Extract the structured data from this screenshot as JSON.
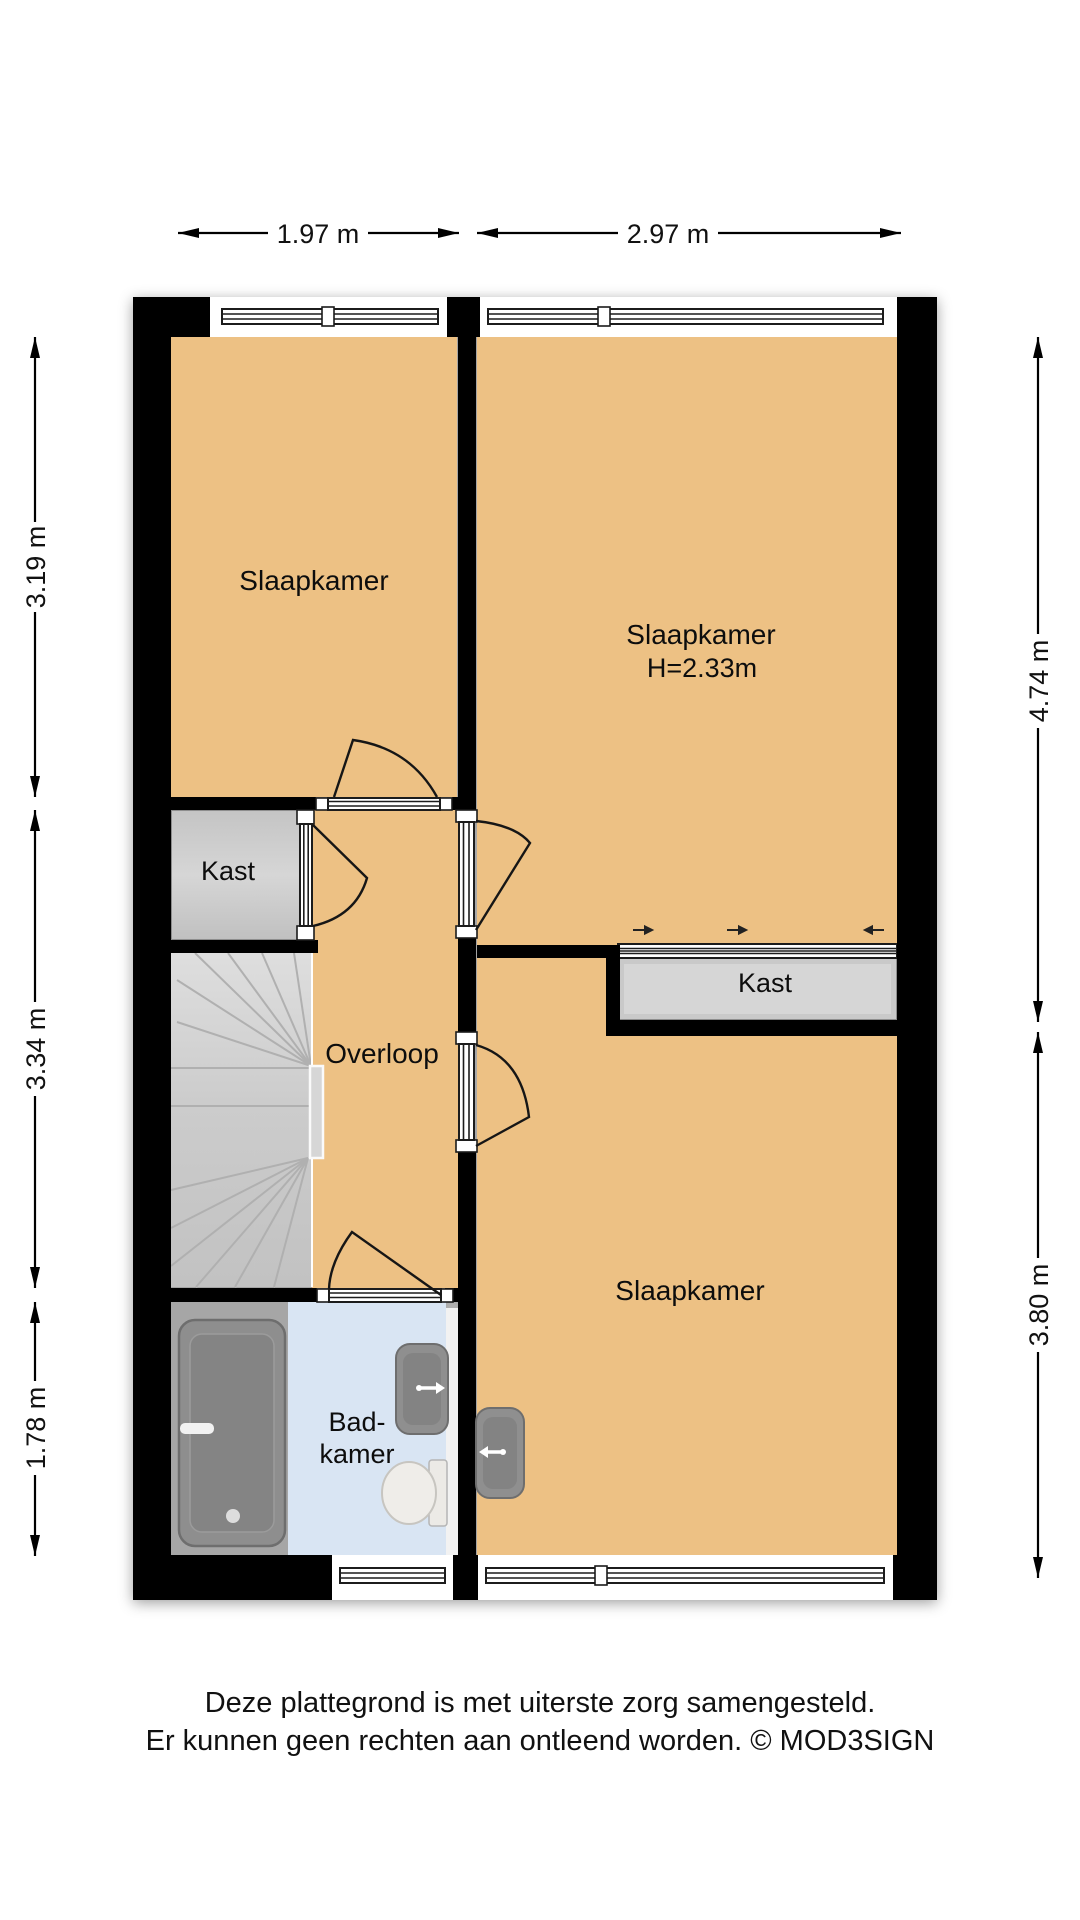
{
  "plan": {
    "colors": {
      "wall": "#000000",
      "floor": "#edc184",
      "closet": "#c9c9c9",
      "bathroom_floor": "#d9e5f3",
      "stairs": "#cdcdcd",
      "fixture": "#8f8f8f"
    },
    "rooms": {
      "bedroom_top_left": {
        "label": "Slaapkamer"
      },
      "bedroom_top_right": {
        "label": "Slaapkamer",
        "height_note": "H=2.33m"
      },
      "bedroom_bottom": {
        "label": "Slaapkamer"
      },
      "closet_left": {
        "label": "Kast"
      },
      "closet_right": {
        "label": "Kast"
      },
      "landing": {
        "label": "Overloop"
      },
      "bathroom": {
        "label_line1": "Bad-",
        "label_line2": "kamer"
      }
    }
  },
  "dimensions": {
    "top": [
      {
        "label": "1.97 m"
      },
      {
        "label": "2.97 m"
      }
    ],
    "left": [
      {
        "label": "3.19 m"
      },
      {
        "label": "3.34 m"
      },
      {
        "label": "1.78 m"
      }
    ],
    "right": [
      {
        "label": "4.74 m"
      },
      {
        "label": "3.80 m"
      }
    ]
  },
  "disclaimer": {
    "line1": "Deze plattegrond is met uiterste zorg samengesteld.",
    "line2": "Er kunnen geen rechten aan ontleend worden. © MOD3SIGN"
  }
}
